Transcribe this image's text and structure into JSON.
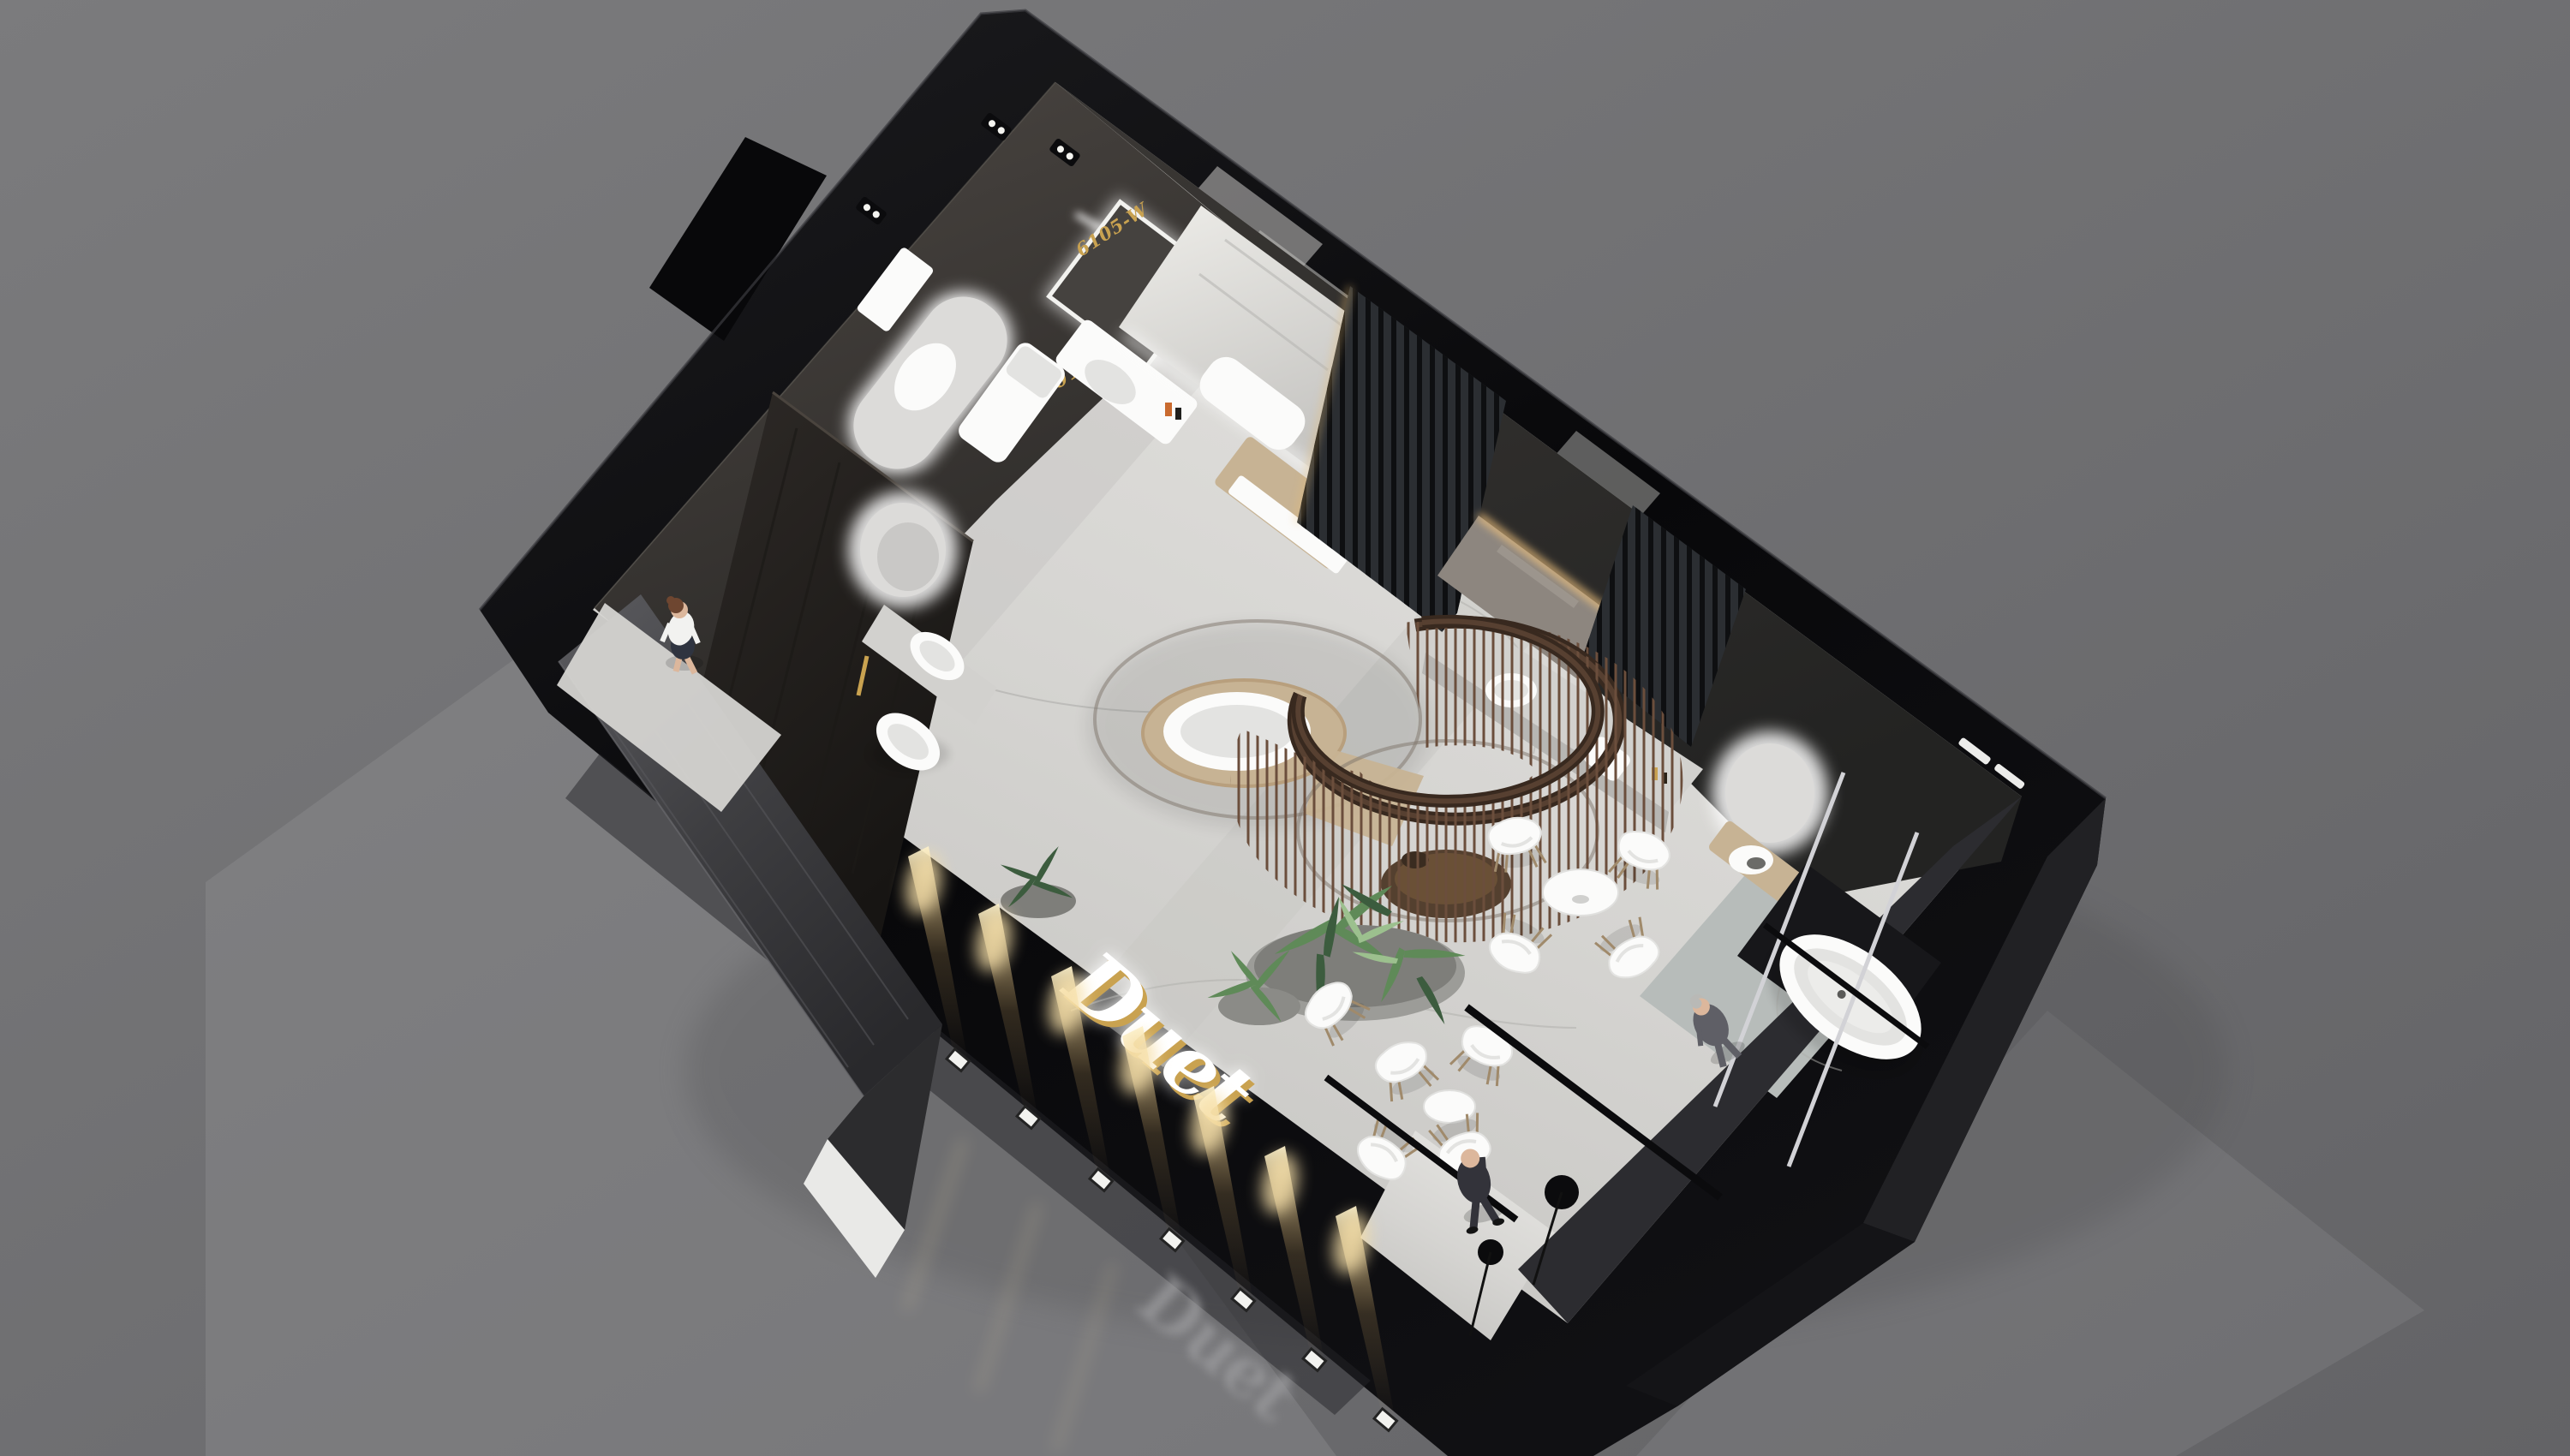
{
  "meta": {
    "title": "Sanitary-ware showroom exhibition booth — aerial 3D render",
    "view": "isometric aerial perspective on studio gray backdrop",
    "booth_type": "bathroom / sanitary ware brand exhibition stand"
  },
  "texts": {
    "brand_logo": "Duet",
    "brand_logo_reflection": "Duet",
    "product_label_arch_mirror": "W-2013",
    "product_label_vanity_mirror": "6105-W"
  },
  "inventory": {
    "people": [
      {
        "role": "hostess walking",
        "clothing": "white blouse, dark skirt",
        "location": "left entrance walkway"
      },
      {
        "role": "visitor on phone",
        "clothing": "dark suit",
        "location": "front entrance corner"
      },
      {
        "role": "visitor standing",
        "clothing": "gray suit",
        "location": "right lounge near freestanding bathtub"
      }
    ],
    "fixtures": [
      "arched backlit mirror with wall-hung toilet reflection",
      "square pedestal basin",
      "framed LED vanity mirror with floating washbasin",
      "marble feature wall with built-in bathtub and wood deck",
      "double C-shaped bronze rod shower enclosure with freestanding oval tub",
      "bronze round display platform",
      "warm-backlit rectangular mirror with stone counter and two vessel basins",
      "vertical wood-slat partitions",
      "round LED mirror with timber shelf vanity",
      "freestanding white bathtub on gray rug",
      "dark wood display wing wall with round backlit mirror, ledge basin and egg-shaped basin",
      "angular stone reception desk"
    ],
    "furniture": {
      "cafe_chairs": 9,
      "cafe_tables": 2,
      "reception_desk": 1
    },
    "lighting": {
      "facade_uplights": 7,
      "ceiling_spot_pairs": 5,
      "led_mirrors": 5,
      "track_light_bars": 3,
      "floor_lamp_discs": 2,
      "chrome_shower_poles": 2
    }
  },
  "colors": {
    "bg_top": "#7b7b7d",
    "bg_bottom": "#636366",
    "reflection": "#8b8b8f",
    "mass_dark": "#08080a",
    "mass_edge": "#1d1d20",
    "facet": "#232327",
    "facet2": "#141417",
    "floor_light": "#e7e6e3",
    "floor_mid": "#d5d4d1",
    "floor_dark": "#c2c1be",
    "vein": "#aeadaa",
    "rug": "#b7bcba",
    "tile": "#c8c7c4",
    "wall_tl": "#4c4743",
    "wall_tl_dark": "#2b2927",
    "wall_br": "#3b3835",
    "wall_br_dark": "#232322",
    "wall_right": "#2c2c30",
    "slat_base": "#2b2e32",
    "slat_line": "#0e0f11",
    "wing": "#2e2a27",
    "wing_dark": "#171513",
    "marble_hi": "#eeede9",
    "marble_lo": "#c5c4c1",
    "white_fix": "#fbfbfa",
    "fix_shade": "#e3e3e1",
    "fix_deep": "#d0d0ce",
    "wood": "#c7b394",
    "wood_dark": "#a08a6b",
    "bronze": "#5f4636",
    "bronze_dark": "#38291f",
    "rod": "#6b4e3c",
    "planter": "#9c9c98",
    "plant_dark": "#3c5c3e",
    "plant_mid": "#5f8a58",
    "plant_light": "#9cc08e",
    "gold": "#c9a250",
    "warm": "#e9bd72",
    "beam_hot": "#f6dfa8",
    "chrome": "#d2d2d6",
    "black_bar": "#0b0b0d",
    "skin": "#dcb79c",
    "hair_brown": "#6e4630",
    "shirt": "#f2f2f0",
    "skirt": "#2f3440",
    "suit_dark": "#33333a",
    "suit_gray": "#5f5f66",
    "hair_gray": "#b9b9b6",
    "desk": "#3e3e41",
    "desk_streak": "#5b5b5f",
    "desk_base": "#e9e9e7",
    "mirror_face": "#dcdbd9",
    "stone": "#d2d1ce",
    "counter_front": "#b7b6b3",
    "led_warm": "#f0c27e",
    "glow": "#ffffff"
  }
}
